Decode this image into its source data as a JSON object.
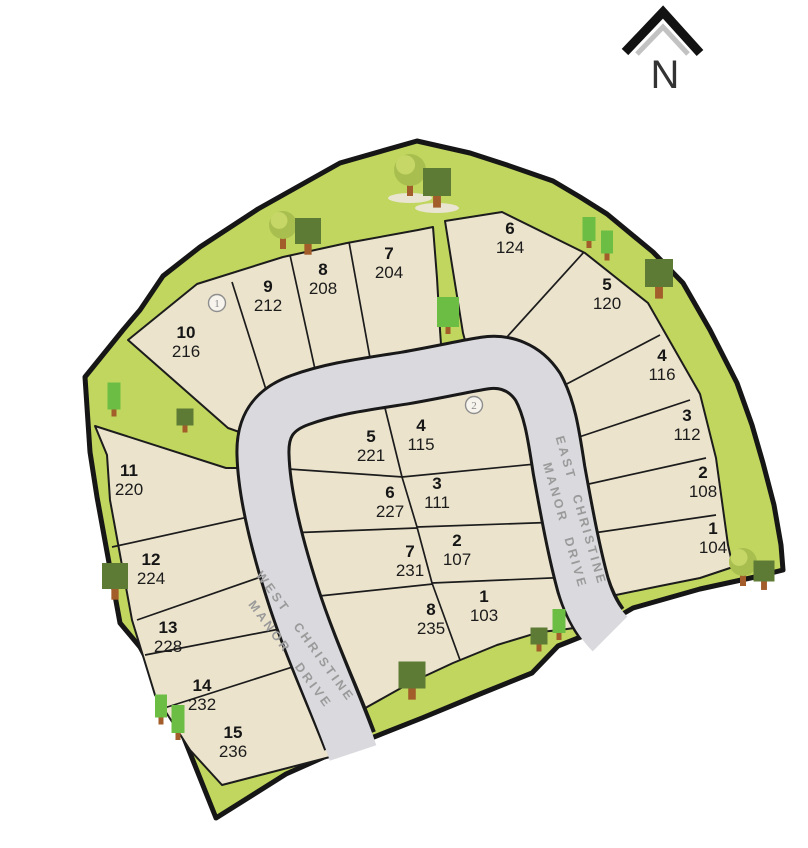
{
  "north_arrow": {
    "label": "N"
  },
  "roads": {
    "west": {
      "line1": "WEST CHRISTINE",
      "line2": "MANOR DRIVE"
    },
    "east": {
      "line1": "EAST CHRISTINE",
      "line2": "MANOR DRIVE"
    }
  },
  "markers": [
    {
      "label": "1",
      "x": 217,
      "y": 303
    },
    {
      "label": "2",
      "x": 474,
      "y": 405
    }
  ],
  "lots": [
    {
      "block": "north",
      "lot": "7",
      "address": "204",
      "x": 389,
      "y": 259
    },
    {
      "block": "north",
      "lot": "8",
      "address": "208",
      "x": 323,
      "y": 275
    },
    {
      "block": "north",
      "lot": "9",
      "address": "212",
      "x": 268,
      "y": 292
    },
    {
      "block": "north",
      "lot": "10",
      "address": "216",
      "x": 186,
      "y": 338
    },
    {
      "block": "east-arc",
      "lot": "6",
      "address": "124",
      "x": 510,
      "y": 234
    },
    {
      "block": "east-arc",
      "lot": "5",
      "address": "120",
      "x": 607,
      "y": 290
    },
    {
      "block": "east-arc",
      "lot": "4",
      "address": "116",
      "x": 662,
      "y": 361
    },
    {
      "block": "east-arc",
      "lot": "3",
      "address": "112",
      "x": 687,
      "y": 421
    },
    {
      "block": "east-arc",
      "lot": "2",
      "address": "108",
      "x": 703,
      "y": 478
    },
    {
      "block": "east-arc",
      "lot": "1",
      "address": "104",
      "x": 713,
      "y": 534
    },
    {
      "block": "inner-west",
      "lot": "5",
      "address": "221",
      "x": 371,
      "y": 442
    },
    {
      "block": "inner-west",
      "lot": "6",
      "address": "227",
      "x": 390,
      "y": 498
    },
    {
      "block": "inner-west",
      "lot": "7",
      "address": "231",
      "x": 410,
      "y": 557
    },
    {
      "block": "inner-west",
      "lot": "8",
      "address": "235",
      "x": 431,
      "y": 615
    },
    {
      "block": "inner-east",
      "lot": "4",
      "address": "115",
      "x": 421,
      "y": 431
    },
    {
      "block": "inner-east",
      "lot": "3",
      "address": "111",
      "x": 437,
      "y": 489
    },
    {
      "block": "inner-east",
      "lot": "2",
      "address": "107",
      "x": 457,
      "y": 546
    },
    {
      "block": "inner-east",
      "lot": "1",
      "address": "103",
      "x": 484,
      "y": 602
    },
    {
      "block": "west-arc",
      "lot": "11",
      "address": "220",
      "x": 129,
      "y": 476
    },
    {
      "block": "west-arc",
      "lot": "12",
      "address": "224",
      "x": 151,
      "y": 565
    },
    {
      "block": "west-arc",
      "lot": "13",
      "address": "228",
      "x": 168,
      "y": 633
    },
    {
      "block": "west-arc",
      "lot": "14",
      "address": "232",
      "x": 202,
      "y": 691
    },
    {
      "block": "west-arc",
      "lot": "15",
      "address": "236",
      "x": 233,
      "y": 738
    }
  ],
  "trees": [
    {
      "type": "round",
      "x": 283,
      "y": 225,
      "r": 14
    },
    {
      "type": "square",
      "x": 308,
      "y": 231,
      "s": 26
    },
    {
      "type": "round",
      "x": 410,
      "y": 170,
      "r": 16,
      "shadow": true
    },
    {
      "type": "square",
      "x": 437,
      "y": 182,
      "s": 28,
      "shadow": true
    },
    {
      "type": "column",
      "x": 448,
      "y": 312,
      "w": 22,
      "h": 30
    },
    {
      "type": "column",
      "x": 589,
      "y": 229,
      "w": 13,
      "h": 24
    },
    {
      "type": "column",
      "x": 607,
      "y": 242,
      "w": 12,
      "h": 23
    },
    {
      "type": "square",
      "x": 659,
      "y": 273,
      "s": 28
    },
    {
      "type": "column",
      "x": 114,
      "y": 396,
      "w": 13,
      "h": 27
    },
    {
      "type": "square",
      "x": 185,
      "y": 417,
      "s": 17
    },
    {
      "type": "square",
      "x": 115,
      "y": 576,
      "s": 26
    },
    {
      "type": "column",
      "x": 161,
      "y": 706,
      "w": 12,
      "h": 23
    },
    {
      "type": "column",
      "x": 178,
      "y": 719,
      "w": 13,
      "h": 28
    },
    {
      "type": "square",
      "x": 412,
      "y": 675,
      "s": 27
    },
    {
      "type": "square",
      "x": 539,
      "y": 636,
      "s": 17
    },
    {
      "type": "column",
      "x": 559,
      "y": 621,
      "w": 13,
      "h": 24
    },
    {
      "type": "round",
      "x": 743,
      "y": 562,
      "r": 14
    },
    {
      "type": "square",
      "x": 764,
      "y": 571,
      "s": 21
    }
  ],
  "colors": {
    "greenbelt": "#c0d65e",
    "lot_tan": "#ebe3cc",
    "road_gray": "#d9d9de",
    "outline_black": "#161616",
    "tree_olive": "#5e7b36",
    "tree_bright": "#6cbd43",
    "tree_round_base": "#a8bf50",
    "tree_round_light": "#c6d768",
    "trunk_brown": "#a25d2a",
    "road_label_gray": "#9a9a9a",
    "north_gray": "#c2c2c2"
  }
}
